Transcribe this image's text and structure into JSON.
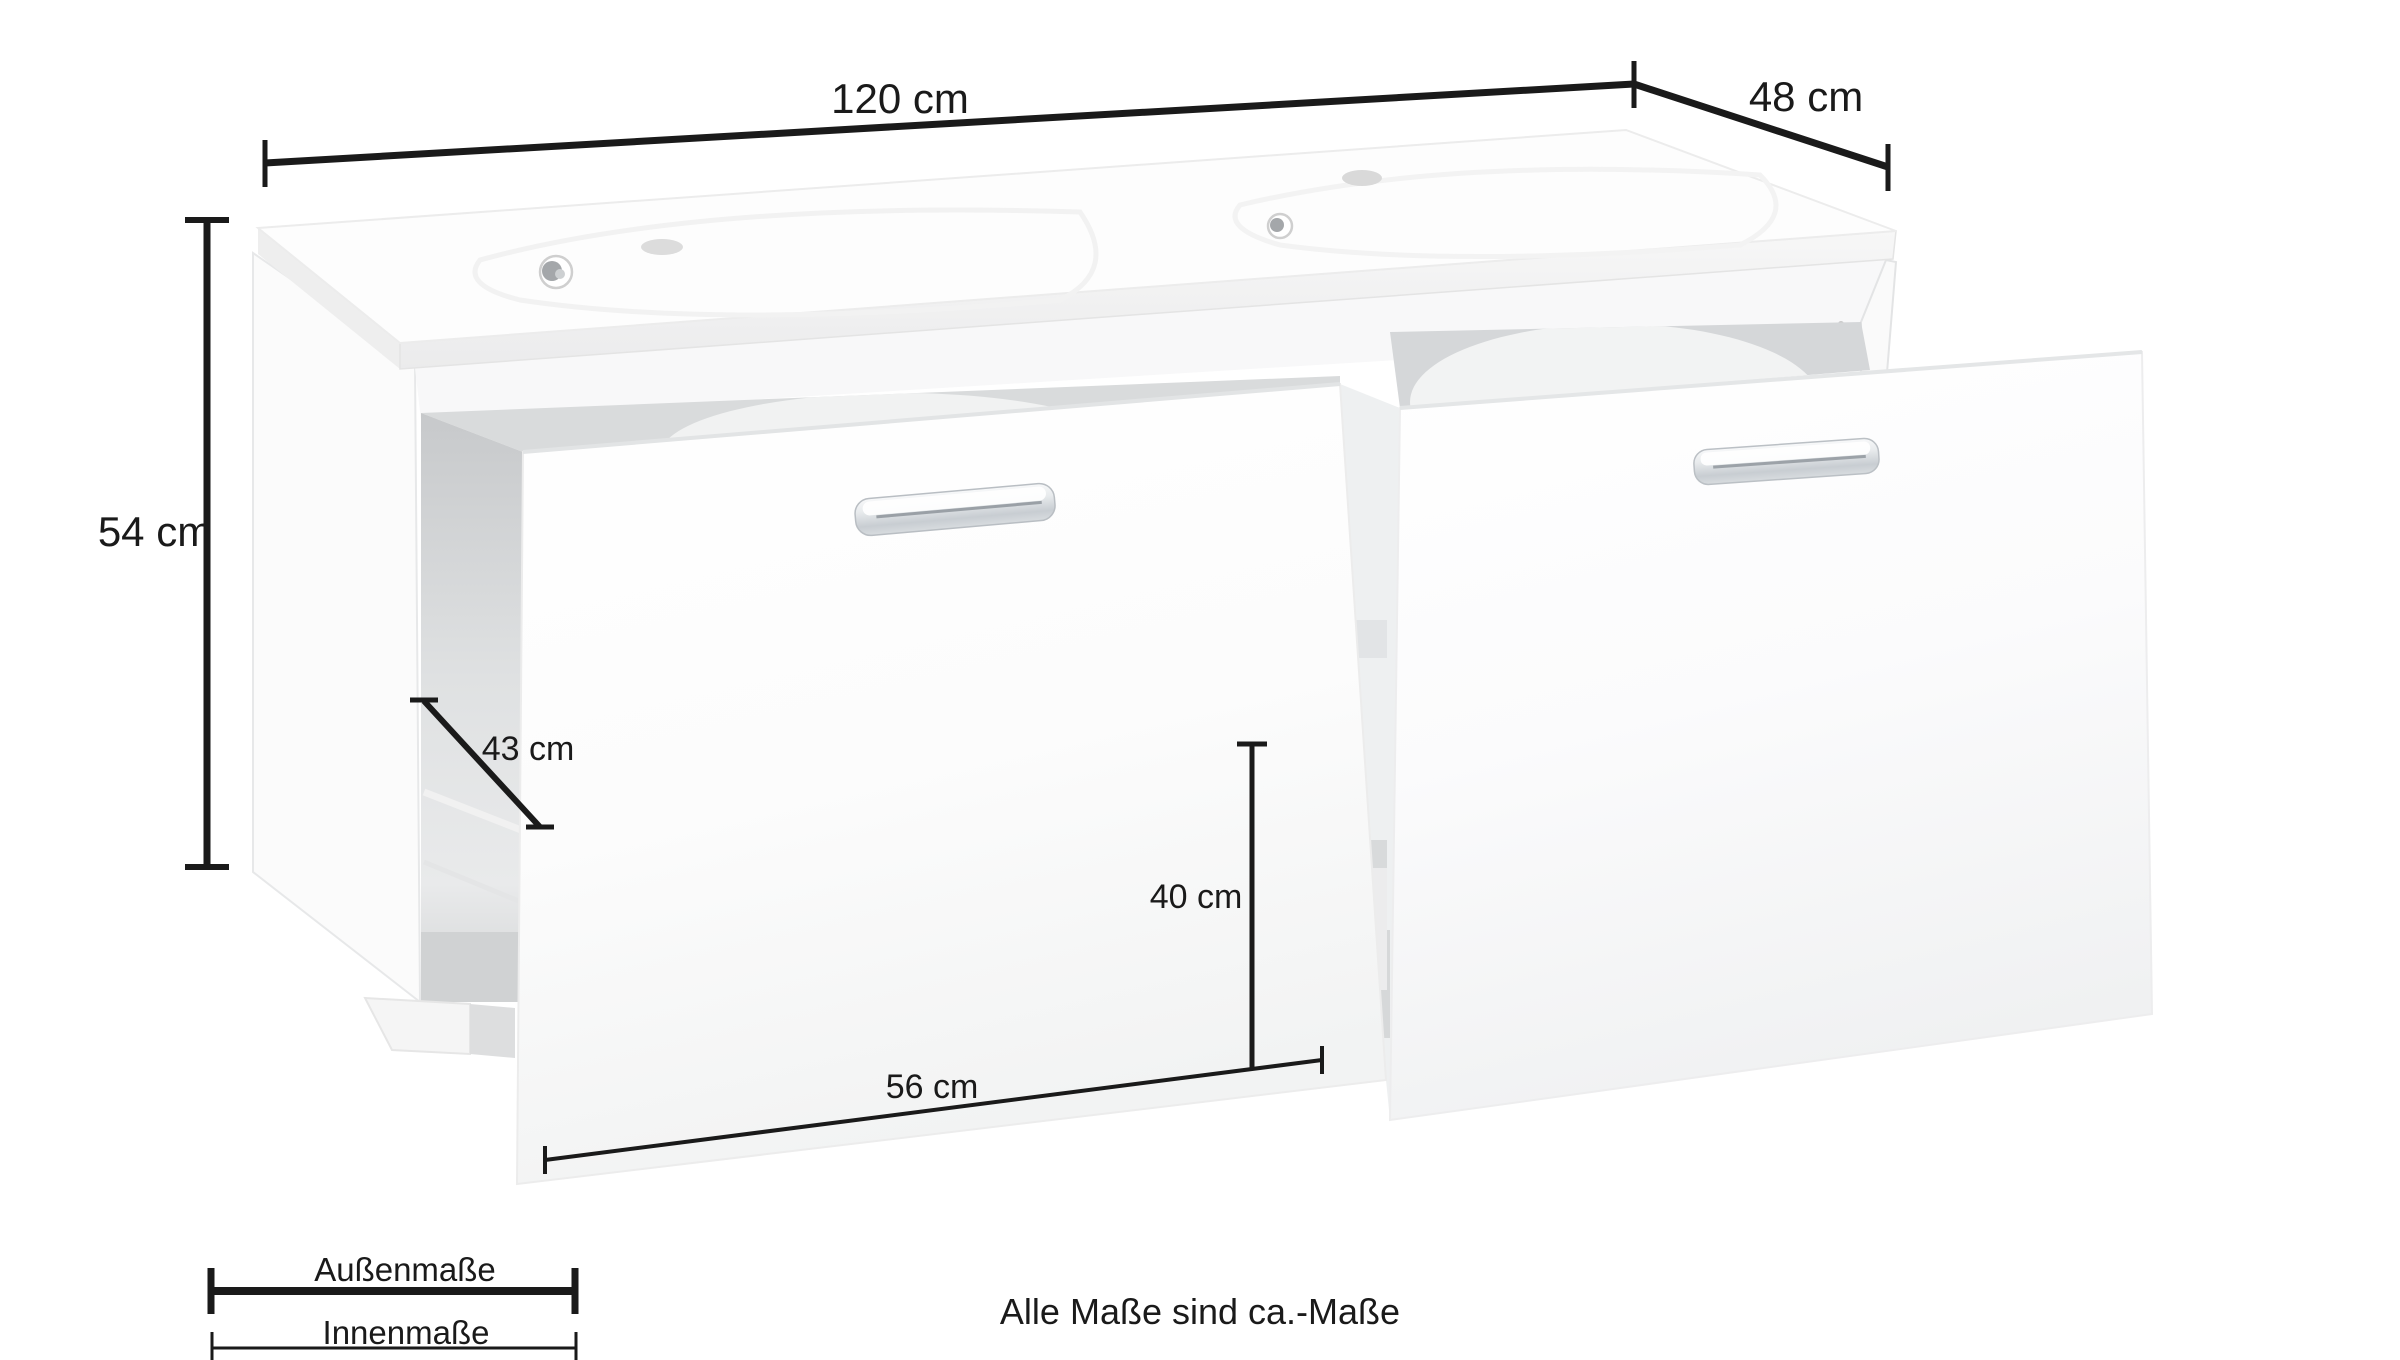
{
  "product": {
    "description": "white double washbasin bathroom vanity with two open drawers, chrome handles"
  },
  "dimensions": {
    "width_outer": "120 cm",
    "depth_outer": "48 cm",
    "height_outer": "54 cm",
    "depth_inner": "43 cm",
    "height_inner": "40 cm",
    "width_inner": "56 cm"
  },
  "legend": {
    "outer_label": "Außenmaße",
    "inner_label": "Innenmaße"
  },
  "footer": {
    "note": "Alle Maße sind ca.-Maße"
  },
  "colors": {
    "annotation": "#1a1a1a",
    "furniture_white": "#ffffff",
    "shadow_light": "#e8e9ea",
    "shadow_mid": "#d6d8da",
    "shadow_dark": "#c7c9cb",
    "chrome": "#cfd4d8"
  }
}
